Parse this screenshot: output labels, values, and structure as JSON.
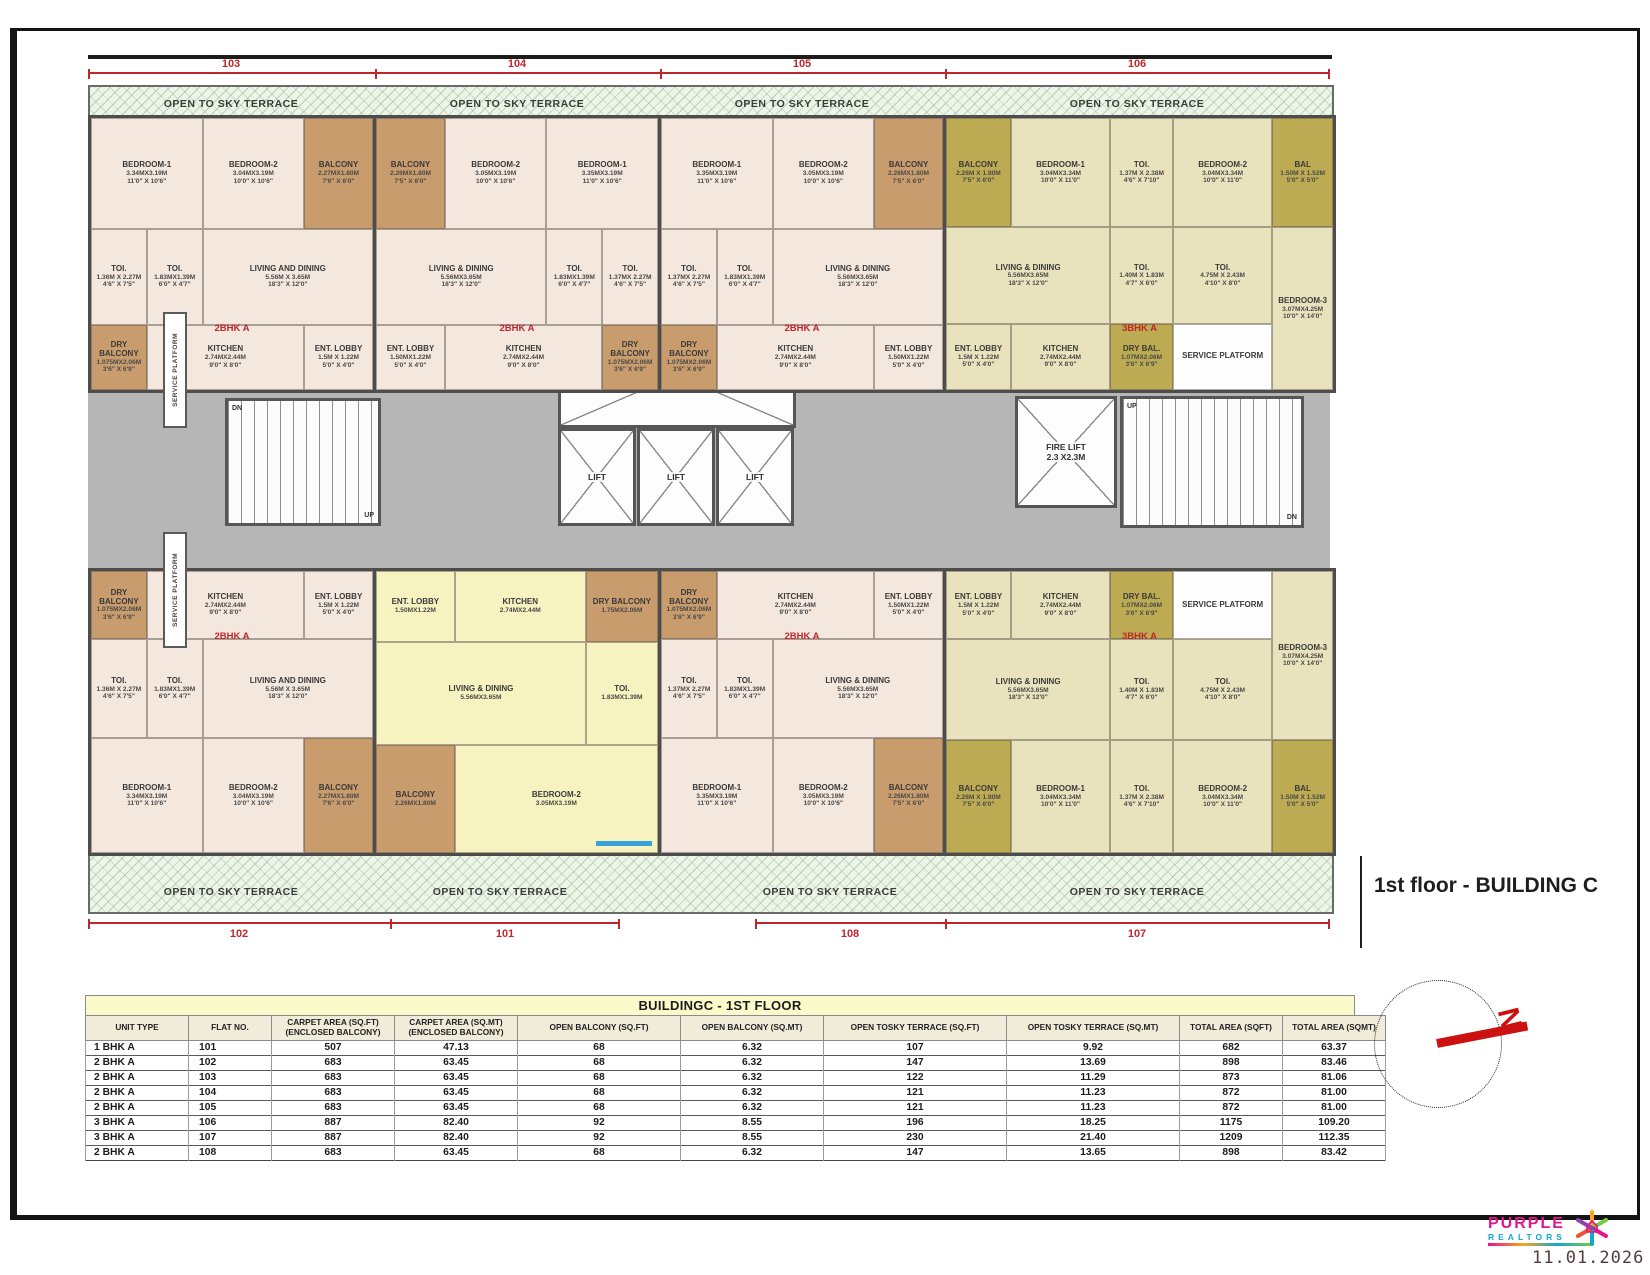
{
  "meta": {
    "floor_title": "1st floor - BUILDING C",
    "date": "11.01.2026"
  },
  "logo": {
    "name": "PURPLE",
    "sub": "REALTORS"
  },
  "compass": {
    "north_label": "N"
  },
  "plan": {
    "terrace_label": "OPEN TO SKY TERRACE",
    "dim_top": [
      "103",
      "104",
      "105",
      "106"
    ],
    "dim_bottom": [
      "102",
      "101",
      "108",
      "107"
    ],
    "core": {
      "lobby": "LOBBY",
      "lift_label": "LIFT",
      "fire_lift_label": "FIRE LIFT",
      "fire_lift_dim": "2.3 X2.3M",
      "passage": "1.50M WIDE PASSAGE",
      "service_platform": "SERVICE PLATFORM",
      "up": "UP",
      "dn": "DN"
    },
    "units": [
      {
        "id": "103",
        "type_label": "2BHK A",
        "rooms": [
          {
            "slot": "b1",
            "name": "BEDROOM-1",
            "d1": "3.34MX3.19M",
            "d2": "11'0\" X 10'6\""
          },
          {
            "slot": "b2",
            "name": "BEDROOM-2",
            "d1": "3.04MX3.19M",
            "d2": "10'0\" X 10'6\""
          },
          {
            "slot": "bal",
            "name": "BALCONY",
            "d1": "2.27MX1.80M",
            "d2": "7'6\" X 6'0\"",
            "c": "balc"
          },
          {
            "slot": "toi",
            "name": "TOI.",
            "d1": "1.36M X 2.27M",
            "d2": "4'6\" X 7'5\""
          },
          {
            "slot": "toi2",
            "name": "TOI.",
            "d1": "1.83MX1.39M",
            "d2": "6'0\" X 4'7\""
          },
          {
            "slot": "ld",
            "name": "LIVING AND DINING",
            "d1": "5.56M X 3.65M",
            "d2": "18'3\" X 12'0\""
          },
          {
            "slot": "dry",
            "name": "DRY BALCONY",
            "d1": "1.075MX2.06M",
            "d2": "3'6\" X 6'9\"",
            "c": "balc"
          },
          {
            "slot": "kit",
            "name": "KITCHEN",
            "d1": "2.74MX2.44M",
            "d2": "9'0\" X 8'0\""
          },
          {
            "slot": "ent",
            "name": "ENT. LOBBY",
            "d1": "1.5M X 1.22M",
            "d2": "5'0\" X 4'0\""
          }
        ]
      },
      {
        "id": "104",
        "type_label": "2BHK A",
        "rooms": [
          {
            "slot": "bal",
            "name": "BALCONY",
            "d1": "2.26MX1.80M",
            "d2": "7'5\" X 6'0\"",
            "c": "balc"
          },
          {
            "slot": "b2",
            "name": "BEDROOM-2",
            "d1": "3.05MX3.19M",
            "d2": "10'0\" X 10'6\""
          },
          {
            "slot": "b1",
            "name": "BEDROOM-1",
            "d1": "3.35MX3.19M",
            "d2": "11'0\" X 10'6\""
          },
          {
            "slot": "toi",
            "name": "TOI.",
            "d1": "1.37MX 2.27M",
            "d2": "4'6\" X 7'5\""
          },
          {
            "slot": "toi2",
            "name": "TOI.",
            "d1": "1.83MX1.39M",
            "d2": "6'0\" X 4'7\""
          },
          {
            "slot": "ld",
            "name": "LIVING & DINING",
            "d1": "5.56MX3.65M",
            "d2": "18'3\" X 12'0\""
          },
          {
            "slot": "ent",
            "name": "ENT. LOBBY",
            "d1": "1.50MX1.22M",
            "d2": "5'0\" X 4'0\""
          },
          {
            "slot": "kit",
            "name": "KITCHEN",
            "d1": "2.74MX2.44M",
            "d2": "9'0\" X 8'0\""
          },
          {
            "slot": "dry",
            "name": "DRY BALCONY",
            "d1": "1.075MX2.06M",
            "d2": "3'6\" X 6'9\"",
            "c": "balc"
          }
        ]
      },
      {
        "id": "105",
        "type_label": "2BHK A",
        "rooms": [
          {
            "slot": "b1",
            "name": "BEDROOM-1",
            "d1": "3.35MX3.19M",
            "d2": "11'0\" X 10'6\""
          },
          {
            "slot": "b2",
            "name": "BEDROOM-2",
            "d1": "3.05MX3.19M",
            "d2": "10'0\" X 10'6\""
          },
          {
            "slot": "bal",
            "name": "BALCONY",
            "d1": "2.26MX1.80M",
            "d2": "7'5\" X 6'0\"",
            "c": "balc"
          },
          {
            "slot": "toi",
            "name": "TOI.",
            "d1": "1.37MX 2.27M",
            "d2": "4'6\" X 7'5\""
          },
          {
            "slot": "toi2",
            "name": "TOI.",
            "d1": "1.83MX1.39M",
            "d2": "6'0\" X 4'7\""
          },
          {
            "slot": "ld",
            "name": "LIVING & DINING",
            "d1": "5.56MX3.65M",
            "d2": "18'3\" X 12'0\""
          },
          {
            "slot": "dry",
            "name": "DRY BALCONY",
            "d1": "1.075MX2.06M",
            "d2": "3'6\" X 6'9\"",
            "c": "balc"
          },
          {
            "slot": "kit",
            "name": "KITCHEN",
            "d1": "2.74MX2.44M",
            "d2": "9'0\" X 8'0\""
          },
          {
            "slot": "ent",
            "name": "ENT. LOBBY",
            "d1": "1.50MX1.22M",
            "d2": "5'0\" X 4'0\""
          }
        ]
      },
      {
        "id": "106",
        "type_label": "3BHK A",
        "rooms": [
          {
            "slot": "bal",
            "name": "BALCONY",
            "d1": "2.26M X 1.80M",
            "d2": "7'5\" X 6'0\"",
            "c": "balc3"
          },
          {
            "slot": "b1",
            "name": "BEDROOM-1",
            "d1": "3.04MX3.34M",
            "d2": "10'0\" X 11'0\""
          },
          {
            "slot": "t1",
            "name": "TOI.",
            "d1": "1.37M X 2.38M",
            "d2": "4'6\" X 7'10\""
          },
          {
            "slot": "b2",
            "name": "BEDROOM-2",
            "d1": "3.04MX3.34M",
            "d2": "10'0\" X 11'0\""
          },
          {
            "slot": "bal2",
            "name": "BAL",
            "d1": "1.50M X 1.52M",
            "d2": "5'0\" X 5'0\"",
            "c": "balc3"
          },
          {
            "slot": "ld",
            "name": "LIVING & DINING",
            "d1": "5.56MX3.65M",
            "d2": "18'3\" X 12'0\""
          },
          {
            "slot": "t2",
            "name": "TOI.",
            "d1": "1.40M X 1.83M",
            "d2": "4'7\" X 6'0\""
          },
          {
            "slot": "t3",
            "name": "TOI.",
            "d1": "4.75M X 2.43M",
            "d2": "4'10\" X 8'0\""
          },
          {
            "slot": "b3",
            "name": "BEDROOM-3",
            "d1": "3.07MX4.25M",
            "d2": "10'0\" X 14'0\""
          },
          {
            "slot": "ent",
            "name": "ENT. LOBBY",
            "d1": "1.5M X 1.22M",
            "d2": "5'0\" X 4'0\""
          },
          {
            "slot": "kit",
            "name": "KITCHEN",
            "d1": "2.74MX2.44M",
            "d2": "9'0\" X 8'0\""
          },
          {
            "slot": "dry",
            "name": "DRY BAL.",
            "d1": "1.07MX2.06M",
            "d2": "3'6\" X 6'9\"",
            "c": "balc3"
          },
          {
            "slot": "sp",
            "name": "SERVICE PLATFORM",
            "d1": "",
            "d2": "",
            "c": "white"
          }
        ]
      },
      {
        "id": "102",
        "type_label": "2BHK A",
        "rooms": [
          {
            "slot": "dry",
            "name": "DRY BALCONY",
            "d1": "1.075MX2.06M",
            "d2": "3'6\" X 6'9\"",
            "c": "balc"
          },
          {
            "slot": "kit",
            "name": "KITCHEN",
            "d1": "2.74MX2.44M",
            "d2": "9'0\" X 8'0\""
          },
          {
            "slot": "ent",
            "name": "ENT. LOBBY",
            "d1": "1.5M X 1.22M",
            "d2": "5'0\" X 4'0\""
          },
          {
            "slot": "toi",
            "name": "TOI.",
            "d1": "1.36M X 2.27M",
            "d2": "4'6\" X 7'5\""
          },
          {
            "slot": "toi2",
            "name": "TOI.",
            "d1": "1.83MX1.39M",
            "d2": "6'0\" X 4'7\""
          },
          {
            "slot": "ld",
            "name": "LIVING AND DINING",
            "d1": "5.56M X 3.65M",
            "d2": "18'3\" X 12'0\""
          },
          {
            "slot": "b1",
            "name": "BEDROOM-1",
            "d1": "3.34MX3.19M",
            "d2": "11'0\" X 10'6\""
          },
          {
            "slot": "b2",
            "name": "BEDROOM-2",
            "d1": "3.04MX3.19M",
            "d2": "10'0\" X 10'6\""
          },
          {
            "slot": "bal",
            "name": "BALCONY",
            "d1": "2.27MX1.80M",
            "d2": "7'6\" X 6'0\"",
            "c": "balc"
          }
        ]
      },
      {
        "id": "101",
        "type_label": "",
        "rooms": [
          {
            "slot": "ent",
            "name": "ENT. LOBBY",
            "d1": "1.50MX1.22M",
            "d2": ""
          },
          {
            "slot": "kit",
            "name": "KITCHEN",
            "d1": "2.74MX2.44M",
            "d2": ""
          },
          {
            "slot": "dry",
            "name": "DRY BALCONY",
            "d1": "1.75MX2.06M",
            "d2": "",
            "c": "balc"
          },
          {
            "slot": "ld",
            "name": "LIVING & DINING",
            "d1": "5.56MX3.65M",
            "d2": ""
          },
          {
            "slot": "toi",
            "name": "TOI.",
            "d1": "1.83MX1.39M",
            "d2": ""
          },
          {
            "slot": "bal",
            "name": "BALCONY",
            "d1": "2.26MX1.80M",
            "d2": "",
            "c": "balc"
          },
          {
            "slot": "b2",
            "name": "BEDROOM-2",
            "d1": "3.05MX3.19M",
            "d2": ""
          }
        ]
      },
      {
        "id": "108",
        "type_label": "2BHK A",
        "rooms": [
          {
            "slot": "dry",
            "name": "DRY BALCONY",
            "d1": "1.075MX2.06M",
            "d2": "3'6\" X 6'9\"",
            "c": "balc"
          },
          {
            "slot": "kit",
            "name": "KITCHEN",
            "d1": "2.74MX2.44M",
            "d2": "9'0\" X 8'0\""
          },
          {
            "slot": "ent",
            "name": "ENT. LOBBY",
            "d1": "1.50MX1.22M",
            "d2": "5'0\" X 4'0\""
          },
          {
            "slot": "toi",
            "name": "TOI.",
            "d1": "1.37MX 2.27M",
            "d2": "4'6\" X 7'5\""
          },
          {
            "slot": "toi2",
            "name": "TOI.",
            "d1": "1.83MX1.39M",
            "d2": "6'0\" X 4'7\""
          },
          {
            "slot": "ld",
            "name": "LIVING & DINING",
            "d1": "5.56MX3.65M",
            "d2": "18'3\" X 12'0\""
          },
          {
            "slot": "b1",
            "name": "BEDROOM-1",
            "d1": "3.35MX3.19M",
            "d2": "11'0\" X 10'6\""
          },
          {
            "slot": "b2",
            "name": "BEDROOM-2",
            "d1": "3.05MX3.19M",
            "d2": "10'0\" X 10'6\""
          },
          {
            "slot": "bal",
            "name": "BALCONY",
            "d1": "2.26MX1.80M",
            "d2": "7'5\" X 6'0\"",
            "c": "balc"
          }
        ]
      },
      {
        "id": "107",
        "type_label": "3BHK A",
        "rooms": [
          {
            "slot": "ent",
            "name": "ENT. LOBBY",
            "d1": "1.5M X 1.22M",
            "d2": "5'0\" X 4'0\""
          },
          {
            "slot": "kit",
            "name": "KITCHEN",
            "d1": "2.74MX2.44M",
            "d2": "9'0\" X 8'0\""
          },
          {
            "slot": "dry",
            "name": "DRY BAL.",
            "d1": "1.07MX2.06M",
            "d2": "3'6\" X 6'9\"",
            "c": "balc3"
          },
          {
            "slot": "sp",
            "name": "SERVICE PLATFORM",
            "d1": "",
            "d2": "",
            "c": "white"
          },
          {
            "slot": "ld",
            "name": "LIVING & DINING",
            "d1": "5.56MX3.65M",
            "d2": "18'3\" X 12'0\""
          },
          {
            "slot": "t2",
            "name": "TOI.",
            "d1": "1.40M X 1.83M",
            "d2": "4'7\" X 6'0\""
          },
          {
            "slot": "t3",
            "name": "TOI.",
            "d1": "4.75M X 2.43M",
            "d2": "4'10\" X 8'0\""
          },
          {
            "slot": "b3",
            "name": "BEDROOM-3",
            "d1": "3.07MX4.25M",
            "d2": "10'0\" X 14'0\""
          },
          {
            "slot": "bal",
            "name": "BALCONY",
            "d1": "2.26M X 1.80M",
            "d2": "7'5\" X 6'0\"",
            "c": "balc3"
          },
          {
            "slot": "b1",
            "name": "BEDROOM-1",
            "d1": "3.04MX3.34M",
            "d2": "10'0\" X 11'0\""
          },
          {
            "slot": "t1",
            "name": "TOI.",
            "d1": "1.37M X 2.38M",
            "d2": "4'6\" X 7'10\""
          },
          {
            "slot": "b2",
            "name": "BEDROOM-2",
            "d1": "3.04MX3.34M",
            "d2": "10'0\" X 11'0\""
          },
          {
            "slot": "bal2",
            "name": "BAL",
            "d1": "1.50M X 1.52M",
            "d2": "5'0\" X 5'0\"",
            "c": "balc3"
          }
        ]
      }
    ]
  },
  "table": {
    "title": "BUILDINGC - 1ST FLOOR",
    "headers": [
      "UNIT TYPE",
      "FLAT NO.",
      "CARPET AREA (SQ.FT)\n(ENCLOSED BALCONY)",
      "CARPET AREA (SQ.MT)\n(ENCLOSED BALCONY)",
      "OPEN BALCONY (SQ.FT)",
      "OPEN BALCONY (SQ.MT)",
      "OPEN TOSKY TERRACE (SQ.FT)",
      "OPEN TOSKY TERRACE (SQ.MT)",
      "TOTAL AREA (SQFT)",
      "TOTAL AREA (SQMT)"
    ],
    "rows": [
      [
        "1 BHK A",
        "101",
        "507",
        "47.13",
        "68",
        "6.32",
        "107",
        "9.92",
        "682",
        "63.37"
      ],
      [
        "2 BHK A",
        "102",
        "683",
        "63.45",
        "68",
        "6.32",
        "147",
        "13.69",
        "898",
        "83.46"
      ],
      [
        "2 BHK A",
        "103",
        "683",
        "63.45",
        "68",
        "6.32",
        "122",
        "11.29",
        "873",
        "81.06"
      ],
      [
        "2 BHK A",
        "104",
        "683",
        "63.45",
        "68",
        "6.32",
        "121",
        "11.23",
        "872",
        "81.00"
      ],
      [
        "2 BHK A",
        "105",
        "683",
        "63.45",
        "68",
        "6.32",
        "121",
        "11.23",
        "872",
        "81.00"
      ],
      [
        "3 BHK A",
        "106",
        "887",
        "82.40",
        "92",
        "8.55",
        "196",
        "18.25",
        "1175",
        "109.20"
      ],
      [
        "3 BHK A",
        "107",
        "887",
        "82.40",
        "92",
        "8.55",
        "230",
        "21.40",
        "1209",
        "112.35"
      ],
      [
        "2 BHK A",
        "108",
        "683",
        "63.45",
        "68",
        "6.32",
        "147",
        "13.65",
        "898",
        "83.42"
      ]
    ]
  }
}
